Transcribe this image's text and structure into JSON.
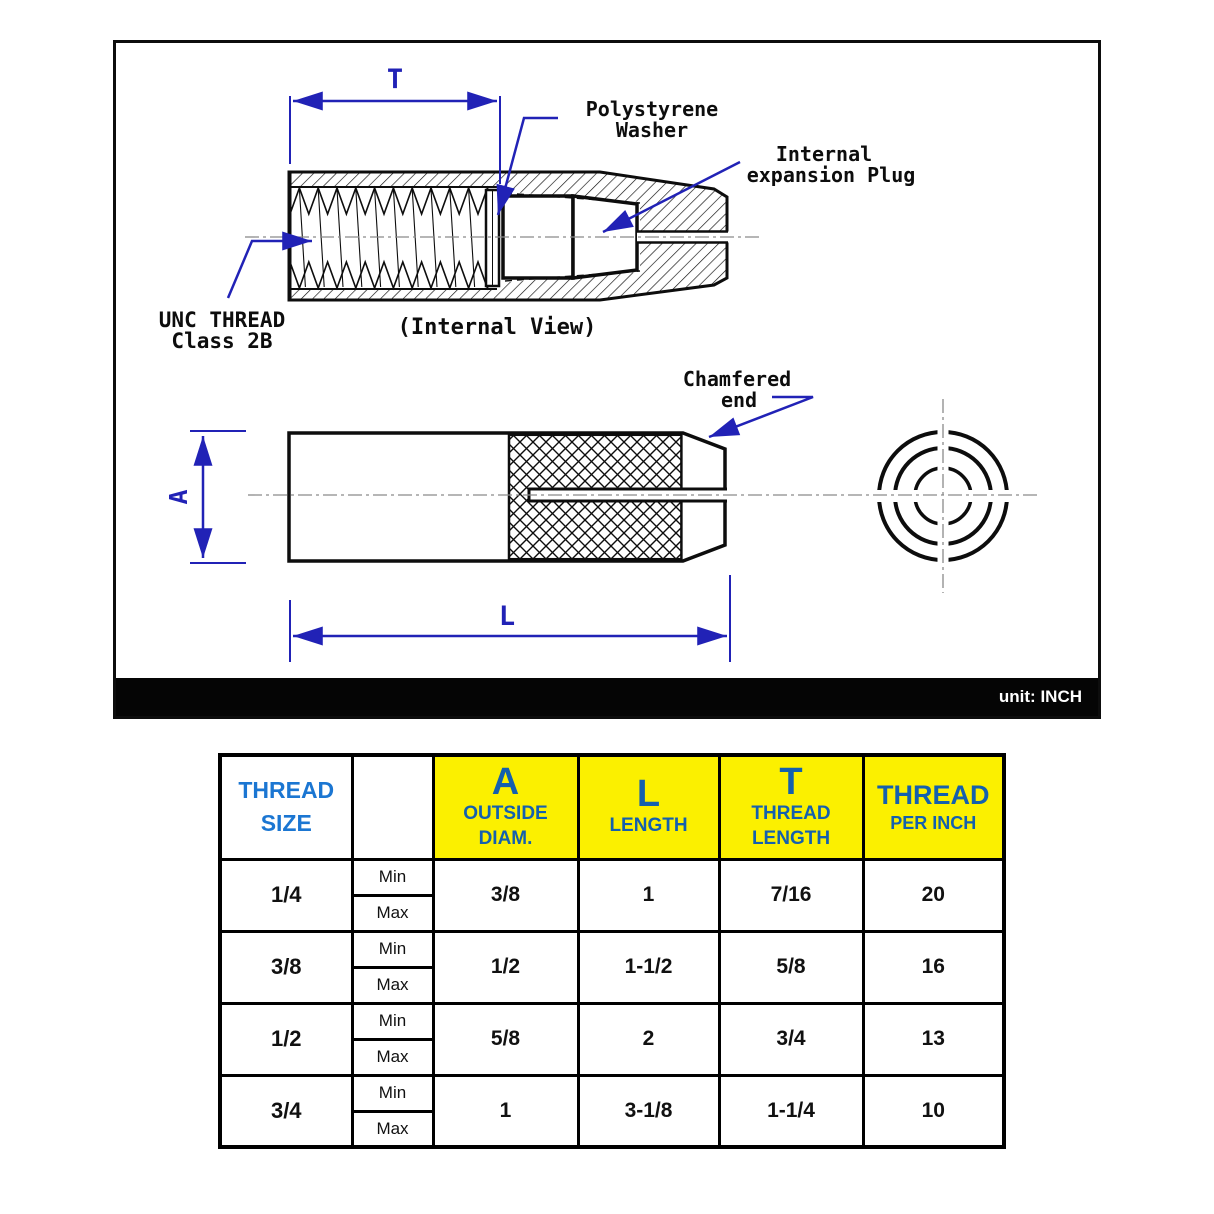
{
  "panel": {
    "unit_label": "unit: INCH",
    "internal_view": {
      "dim_t": "T",
      "washer_label_line1": "Polystyrene",
      "washer_label_line2": "Washer",
      "plug_label_line1": "Internal",
      "plug_label_line2": "expansion Plug",
      "thread_label_line1": "UNC THREAD",
      "thread_label_line2": "Class 2B",
      "caption": "(Internal View)"
    },
    "side_view": {
      "dim_a": "A",
      "dim_l": "L",
      "chamfer_label_line1": "Chamfered",
      "chamfer_label_line2": "end"
    },
    "colors": {
      "annotation_blue": "#2122b6",
      "line_black": "#0d0d0d",
      "centerline_gray": "#8a8a8a",
      "unit_bar_black": "#050505"
    }
  },
  "table": {
    "header": {
      "thread_size_line1": "THREAD",
      "thread_size_line2": "SIZE",
      "a_big": "A",
      "a_sub1": "OUTSIDE",
      "a_sub2": "DIAM.",
      "l_big": "L",
      "l_sub": "LENGTH",
      "t_big": "T",
      "t_sub1": "THREAD",
      "t_sub2": "LENGTH",
      "tpi_line1": "THREAD",
      "tpi_line2": "PER INCH"
    },
    "min_label": "Min",
    "max_label": "Max",
    "rows": [
      {
        "size": "1/4",
        "a": "3/8",
        "l": "1",
        "t": "7/16",
        "tpi": "20"
      },
      {
        "size": "3/8",
        "a": "1/2",
        "l": "1-1/2",
        "t": "5/8",
        "tpi": "16"
      },
      {
        "size": "1/2",
        "a": "5/8",
        "l": "2",
        "t": "3/4",
        "tpi": "13"
      },
      {
        "size": "3/4",
        "a": "1",
        "l": "3-1/8",
        "t": "1-1/4",
        "tpi": "10"
      }
    ],
    "colors": {
      "header_yellow": "#FBF000",
      "thread_size_blue": "#1b76d2",
      "yellow_cell_blue": "#1460ae"
    }
  }
}
